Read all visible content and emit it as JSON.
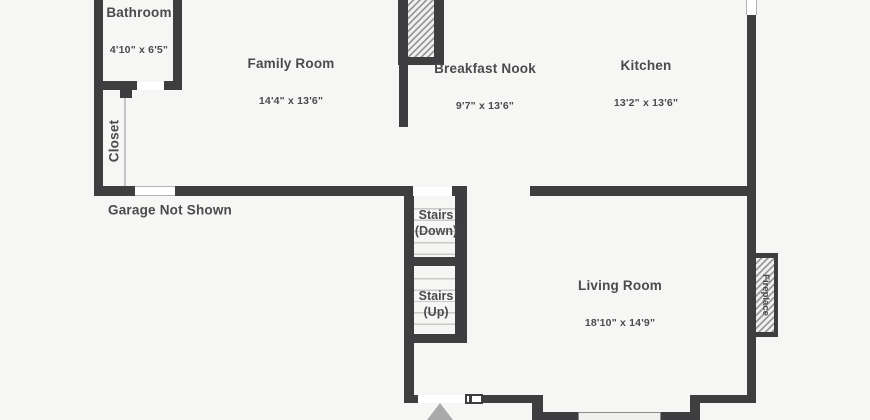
{
  "plan": {
    "rooms": {
      "bathroom": {
        "name": "Bathroom",
        "dims": "4'10\" x 6'5\""
      },
      "closet": {
        "name": "Closet"
      },
      "family_room": {
        "name": "Family Room",
        "dims": "14'4\" x 13'6\""
      },
      "breakfast_nook": {
        "name": "Breakfast Nook",
        "dims": "9'7\" x 13'6\""
      },
      "kitchen": {
        "name": "Kitchen",
        "dims": "13'2\" x 13'6\""
      },
      "living_room": {
        "name": "Living Room",
        "dims": "18'10\" x 14'9\""
      },
      "stairs_down": {
        "label": "Stairs\n(Down)"
      },
      "stairs_up": {
        "label": "Stairs\n(Up)"
      },
      "fireplace": {
        "label": "Fireplace"
      }
    },
    "notes": {
      "garage": "Garage Not Shown"
    },
    "colors": {
      "wall": "#3e3e40",
      "background": "#f6f6f5",
      "text": "#4b4b4d",
      "stair_tread": "#c9c9c9",
      "hatch": "#9a9a9a",
      "north_arrow": "#a9a9a9"
    }
  }
}
